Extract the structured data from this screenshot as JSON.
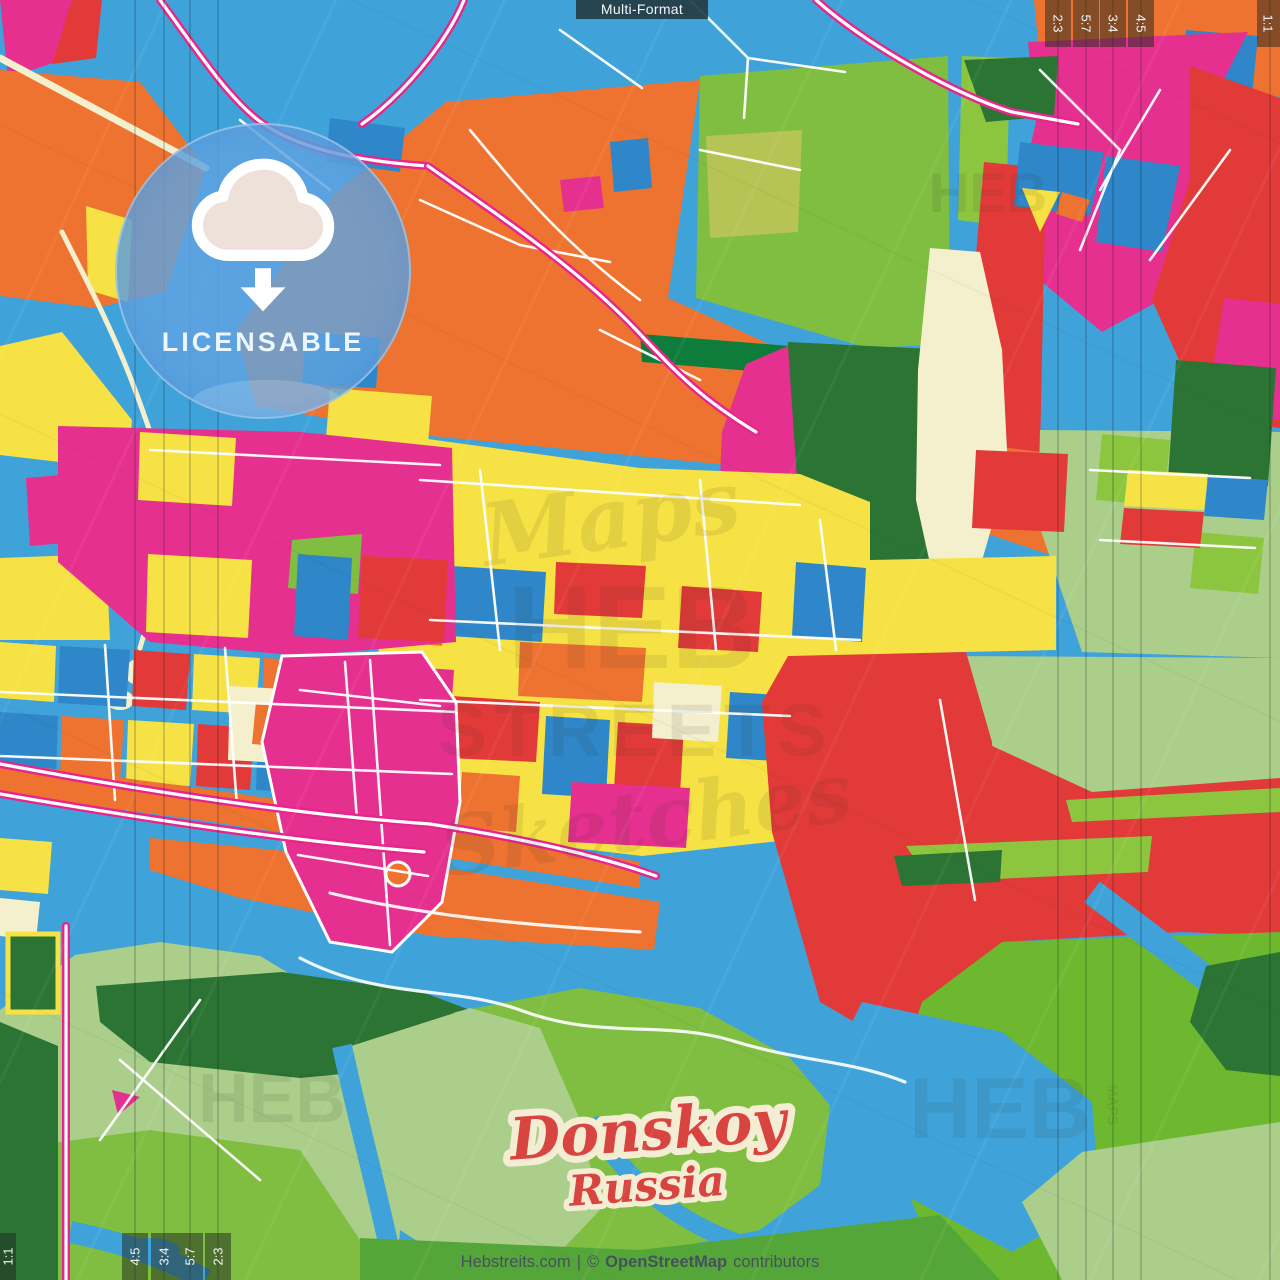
{
  "map": {
    "badges": {
      "format": "Multi-Format",
      "license": "LICENSABLE"
    },
    "place": {
      "title": "Donskoy",
      "subtitle": "Russia"
    },
    "attribution": {
      "site": "Hebstreits.com",
      "separator": "|",
      "copyright": "©",
      "source": "OpenStreetMap",
      "suffix": "contributors"
    },
    "guides": {
      "top_right": [
        "2:3",
        "5:7",
        "3:4",
        "4:5"
      ],
      "top_right_corner": "1:1",
      "bottom_left": [
        "4:5",
        "3:4",
        "5:7",
        "2:3"
      ],
      "bottom_left_corner": "1:1"
    },
    "watermark": {
      "line1": "Maps",
      "line2": "HEB",
      "line3": "STREETS",
      "line4": "Sketches",
      "corner_bottom_left": "HEB",
      "corner_bottom_right": "HEB",
      "corner_top_right": "HEB",
      "side_label": "MAPS"
    },
    "palette": {
      "water_blue": "#3FA3DA",
      "orange": "#EE7330",
      "yellow": "#F6E244",
      "magenta": "#E6308F",
      "red": "#E23A38",
      "grass_green": "#7FBE41",
      "lime_green": "#8CC63F",
      "pale_green": "#ABCF8B",
      "dark_green": "#2B7434",
      "emerald": "#0E7C3B",
      "cream": "#F4F0CE",
      "street_white": "#FFFFFF",
      "road_pink": "#E8258C",
      "badge_dark": "#24434E",
      "license_blue": "#60A3E0",
      "title_red": "#D8443F",
      "title_outline": "#F4EDD3",
      "attribution_text": "#45525A"
    }
  }
}
